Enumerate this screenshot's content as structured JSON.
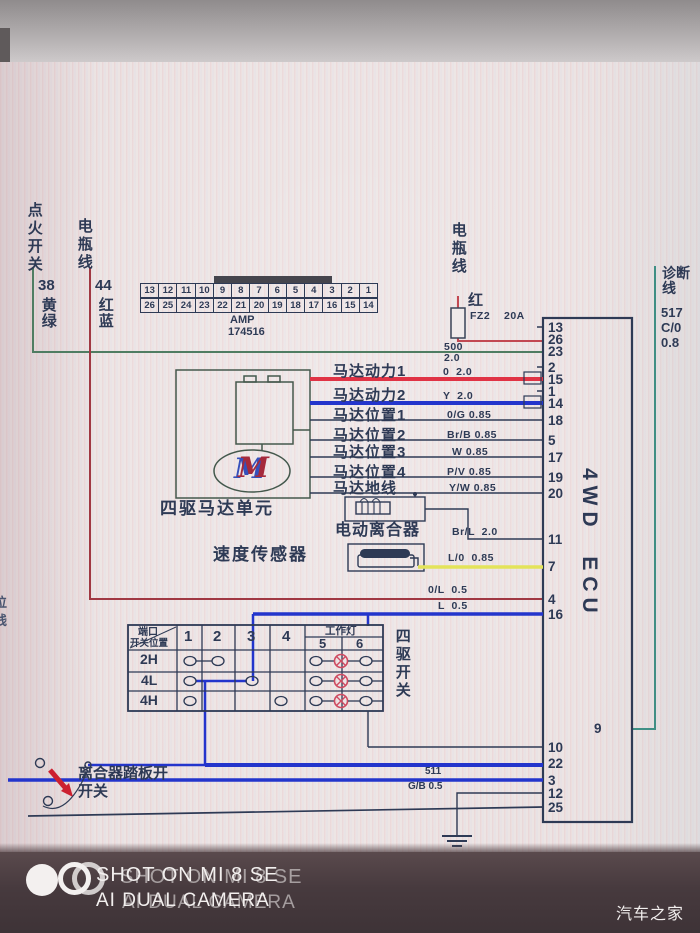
{
  "left_labels": {
    "ignition_switch": "点火开关",
    "battery_line": "电瓶线",
    "wire38_num": "38",
    "wire38_color": "黄绿",
    "wire44_num": "44",
    "wire44_color": "红蓝"
  },
  "connector": {
    "name": "AMP",
    "part_no": "174516",
    "row_top": [
      "13",
      "12",
      "11",
      "10",
      "9",
      "8",
      "7",
      "6",
      "5",
      "4",
      "3",
      "2",
      "1"
    ],
    "row_bottom": [
      "26",
      "25",
      "24",
      "23",
      "22",
      "21",
      "20",
      "19",
      "18",
      "17",
      "16",
      "15",
      "14"
    ]
  },
  "battery_right": {
    "label": "电瓶线",
    "wire_color": "红",
    "fuse_name": "FZ2",
    "fuse_rating": "20A",
    "circuit_no": "500",
    "wire_gauge": "2.0"
  },
  "diagnostic": {
    "label": "诊断线",
    "circuit_no": "517",
    "wire_code": "C/0",
    "wire_gauge": "0.8"
  },
  "ecu": {
    "title": "4WD  ECU",
    "pins_left": [
      "13",
      "26",
      "23",
      "2",
      "15",
      "1",
      "14",
      "18",
      "5",
      "17",
      "19",
      "20",
      "11",
      "7",
      "4",
      "16"
    ],
    "pins_bottom": [
      "10",
      "22",
      "3",
      "12",
      "25"
    ],
    "pin_inner": "9"
  },
  "motor": {
    "unit_label": "四驱马达单元",
    "motor_mark": "M",
    "rows": [
      {
        "label": "马达动力1",
        "wire": "0  2.0"
      },
      {
        "label": "马达动力2",
        "wire": "Y  2.0"
      },
      {
        "label": "马达位置1",
        "wire": "0/G 0.85"
      },
      {
        "label": "马达位置2",
        "wire": "Br/B 0.85"
      },
      {
        "label": "马达位置3",
        "wire": "W 0.85"
      },
      {
        "label": "马达位置4",
        "wire": "P/V 0.85"
      },
      {
        "label": "马达地线",
        "wire": "Y/W 0.85"
      }
    ]
  },
  "clutch": {
    "label": "电动离合器",
    "wire": "Br/L  2.0"
  },
  "speed_sensor": {
    "label": "速度传感器",
    "wire": "L/0  0.85"
  },
  "mid_wires": {
    "ol": "0/L  0.5",
    "l": "L  0.5"
  },
  "switch_table": {
    "corner_top": "端口",
    "corner_bottom": "开关位置",
    "positions": [
      "1",
      "2",
      "3",
      "4"
    ],
    "work_light": "工作灯",
    "lamp_cols": [
      "5",
      "6"
    ],
    "rows": [
      "2H",
      "4L",
      "4H"
    ],
    "side_label": "四驱开关"
  },
  "pedal_switch": {
    "label_line1": "离合器踏板开",
    "label_line2": "开关"
  },
  "bottom_wire": {
    "circuit_no": "511",
    "wire_code": "G/B 0.5"
  },
  "edge_fragments": {
    "char1": "位",
    "char2": "线"
  },
  "watermark": {
    "line1": "SHOT ON MI 8 SE",
    "line2": "AI DUAL CAMERA",
    "brand": "汽车之家"
  },
  "colors": {
    "line": "#2e3a55",
    "wire_red": "#e03345",
    "wire_blue": "#2335cc",
    "wire_yellow": "#e3e35a",
    "wire_green": "#4f7d62",
    "wire_teal": "#3f8f85",
    "wire_maroon": "#a03843",
    "lamp_red": "#d4455a"
  }
}
